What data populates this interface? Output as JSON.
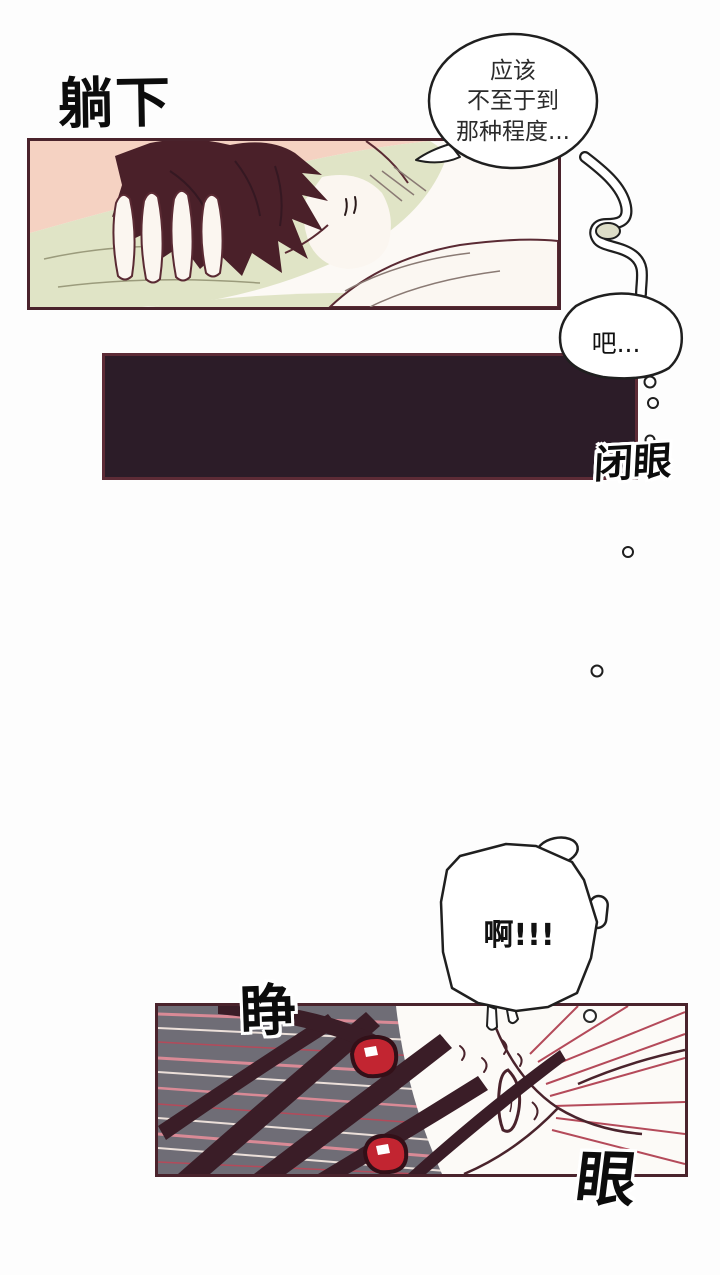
{
  "page": {
    "width": 720,
    "height": 1275,
    "type": "manhwa-page"
  },
  "sfx": {
    "lie_down": "躺下",
    "close_eyes": "闭眼",
    "open_eyes_left": "睁",
    "open_eyes_right": "眼"
  },
  "bubbles": {
    "thought_main": "应该\n不至于到\n那种程度...",
    "thought_tail": "吧...",
    "shout": "啊!!!"
  },
  "colors": {
    "page_bg": "#fdfdfd",
    "panel_border": "#4a232c",
    "dark_panel_fill": "#2c1c28",
    "dark_panel_border": "#5d2b36",
    "pink_bg": "#f5d2c2",
    "pillow_green": "#e0e4c6",
    "hair_maroon": "#4a2029",
    "hair_dark": "#3a1d27",
    "panel_gray": "#6f6d76",
    "speed_line_pink": "#d98a96",
    "speed_line_light": "#ece0da",
    "speed_line_red": "#b44a5a",
    "eye_red": "#c22531",
    "ink": "#1f1f1f",
    "line_maroon": "#5a2a33",
    "skin_white": "#fbf6f0"
  }
}
